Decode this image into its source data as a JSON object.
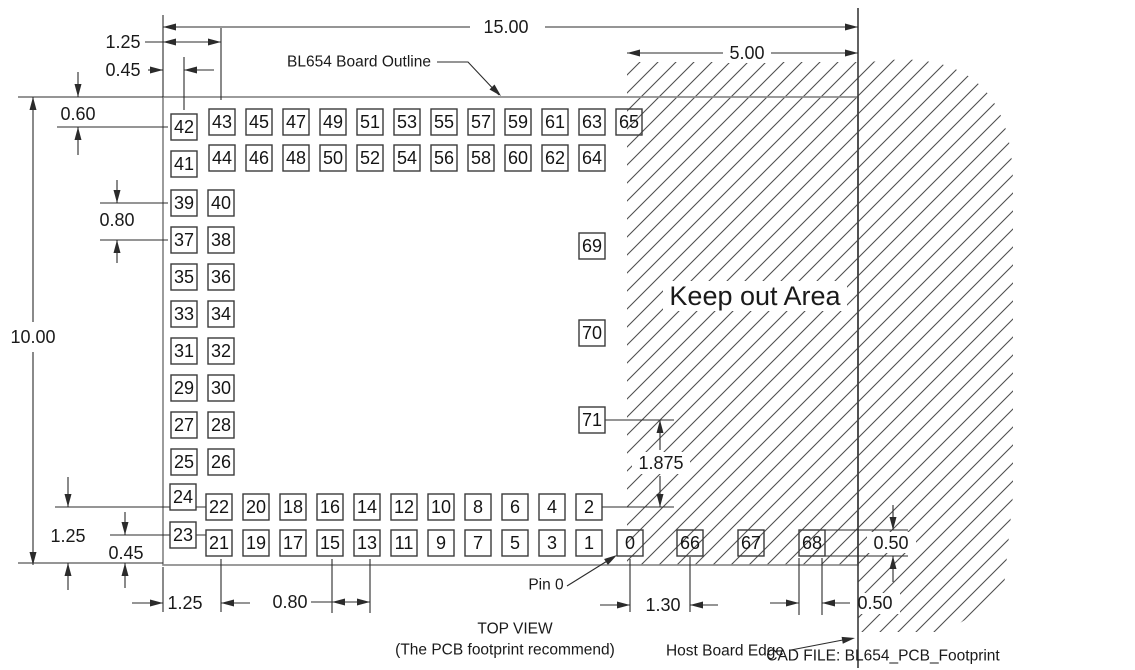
{
  "drawing": {
    "annotations": {
      "board_outline_label": "BL654 Board Outline",
      "keep_out_area": "Keep out Area",
      "pin0_label": "Pin 0",
      "top_view": "TOP VIEW",
      "top_view_note": "(The PCB footprint recommend)",
      "host_board_edge": "Host Board Edge",
      "cad_file": "CAD FILE: BL654_PCB_Footprint"
    },
    "dimensions": {
      "overall_width": "15.00",
      "keepout_width": "5.00",
      "top_col_offset": "1.25",
      "top_edge_offset": "0.45",
      "top_row_offset": "0.60",
      "left_pad_pitch": "0.80",
      "overall_height": "10.00",
      "bottom_row_offset": "1.25",
      "bottom_edge_offset": "0.45",
      "bottom_col_offset": "1.25",
      "bottom_pad_pitch": "0.80",
      "right_pad_pitch": "1.875",
      "ext_pad_spacing": "1.30",
      "pad_width": "0.50",
      "pad_height": "0.50"
    },
    "pads": {
      "top_row_a": [
        "43",
        "45",
        "47",
        "49",
        "51",
        "53",
        "55",
        "57",
        "59",
        "61",
        "63",
        "65"
      ],
      "top_row_b": [
        "44",
        "46",
        "48",
        "50",
        "52",
        "54",
        "56",
        "58",
        "60",
        "62",
        "64"
      ],
      "left_top_pair": [
        "42",
        "41"
      ],
      "left_pairs": [
        [
          "39",
          "40"
        ],
        [
          "37",
          "38"
        ],
        [
          "35",
          "36"
        ],
        [
          "33",
          "34"
        ],
        [
          "31",
          "32"
        ],
        [
          "29",
          "30"
        ],
        [
          "27",
          "28"
        ],
        [
          "25",
          "26"
        ]
      ],
      "left_bottom_pair": [
        "24",
        "23"
      ],
      "bottom_row_a": [
        "22",
        "20",
        "18",
        "16",
        "14",
        "12",
        "10",
        "8",
        "6",
        "4",
        "2"
      ],
      "bottom_row_b": [
        "21",
        "19",
        "17",
        "15",
        "13",
        "11",
        "9",
        "7",
        "5",
        "3",
        "1"
      ],
      "right_col": [
        "69",
        "70",
        "71"
      ],
      "ext_row": [
        "0",
        "66",
        "67",
        "68"
      ],
      "pads_in_hatch": [
        "0",
        "65",
        "66",
        "67",
        "68"
      ]
    },
    "colors": {
      "background": "#ffffff",
      "line": "#2b2b2b",
      "module_outline": "#8a8a8a",
      "hatch": "#4f4f4f",
      "text": "#1a1a1a"
    }
  }
}
